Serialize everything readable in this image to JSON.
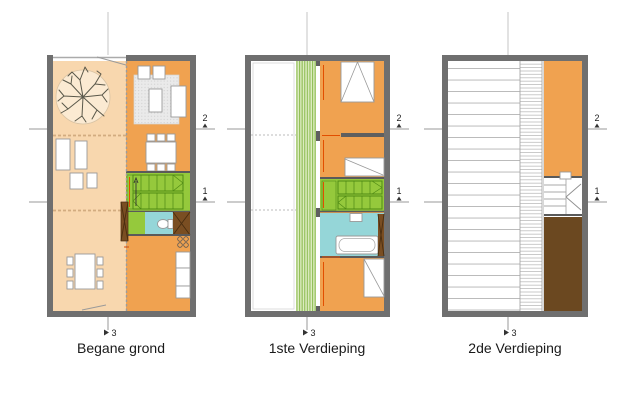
{
  "page": {
    "background": "#FFFFFF",
    "type": "architectural floor plans"
  },
  "colors": {
    "wall": "#6F6F6F",
    "orange": "#F0A250",
    "peach": "#F8D7AE",
    "green": "#95C93C",
    "green_line": "#4E8A14",
    "louver_bg": "#DCEBC0",
    "louver_stripe": "#8FBE55",
    "cyan": "#95D6D8",
    "brown": "#7A4E22",
    "brown_dark": "#6B4820",
    "rug": "#EAEAEA",
    "dim": "#E24E00",
    "text": "#1A1A1A"
  },
  "plans": [
    {
      "id": "begane-grond",
      "label": "Begane grond",
      "markers": {
        "section_2": "2",
        "section_1": "1",
        "section_3": "3"
      }
    },
    {
      "id": "1ste-verdieping",
      "label": "1ste Verdieping",
      "markers": {
        "section_2": "2",
        "section_1": "1",
        "section_3": "3"
      }
    },
    {
      "id": "2de-verdieping",
      "label": "2de Verdieping",
      "markers": {
        "section_2": "2",
        "section_1": "1",
        "section_3": "3"
      }
    }
  ]
}
